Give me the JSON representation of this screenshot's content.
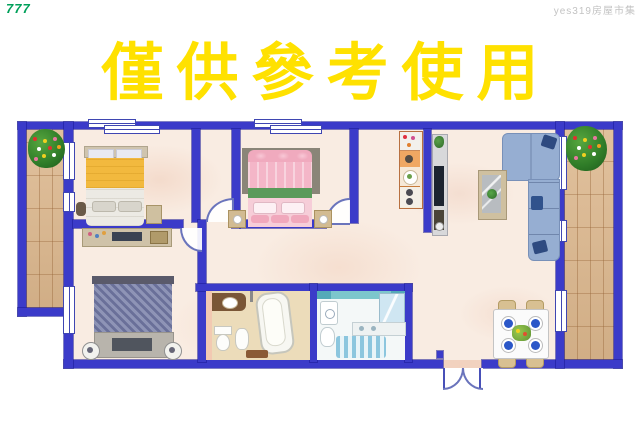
{
  "watermarks": {
    "top_left": "777",
    "top_right": "yes319房屋市集"
  },
  "title": {
    "text": "僅供參考使用",
    "color": "#FFE100"
  },
  "palette": {
    "wall_blue": "#3B3BC9",
    "floor_marble": "#F9ECE2",
    "balcony_wood": "#DCB78D",
    "title_yellow": "#FFE100",
    "watermark_green": "#00A05A",
    "watermark_gray": "#C3C3C3",
    "sofa_blue": "#96AED2",
    "bed1_blanket_yellow": "#F2B93E",
    "bed2_pink": "#F4B6C8",
    "bed3_blue": "#7880A8",
    "bathroom_teal": "#7CC6CC",
    "dining_plate_blue": "#2B57C8"
  }
}
